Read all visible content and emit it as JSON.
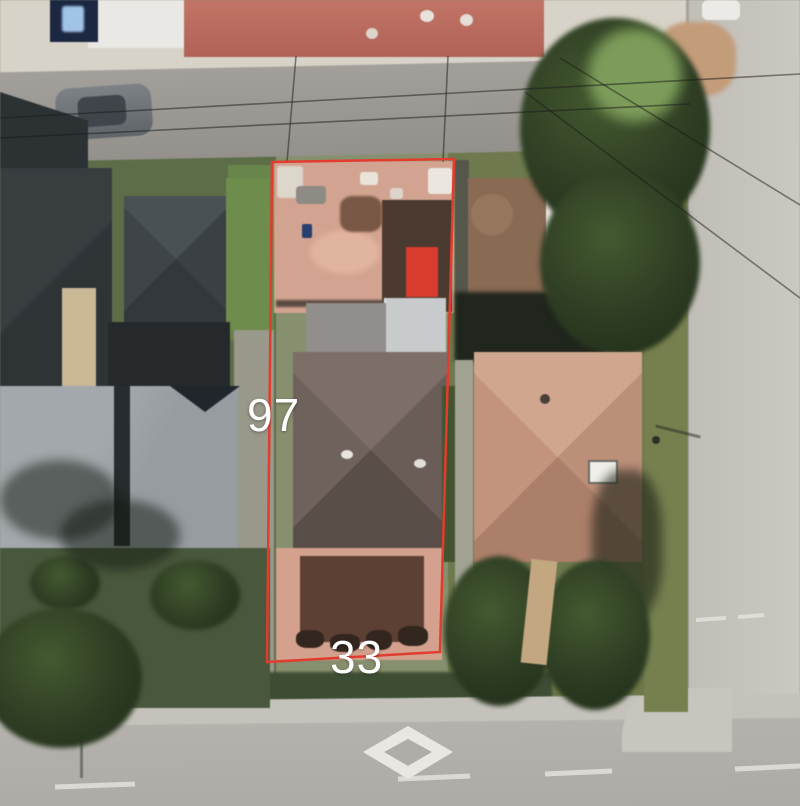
{
  "map_view": {
    "parcel_overlay": {
      "outline_color": "#e23c2e",
      "side_label": "97",
      "bottom_label": "33"
    },
    "road_markings": {
      "diamond_marking": "reserved-lane-diamond",
      "lane_line": "dashed-white"
    }
  }
}
